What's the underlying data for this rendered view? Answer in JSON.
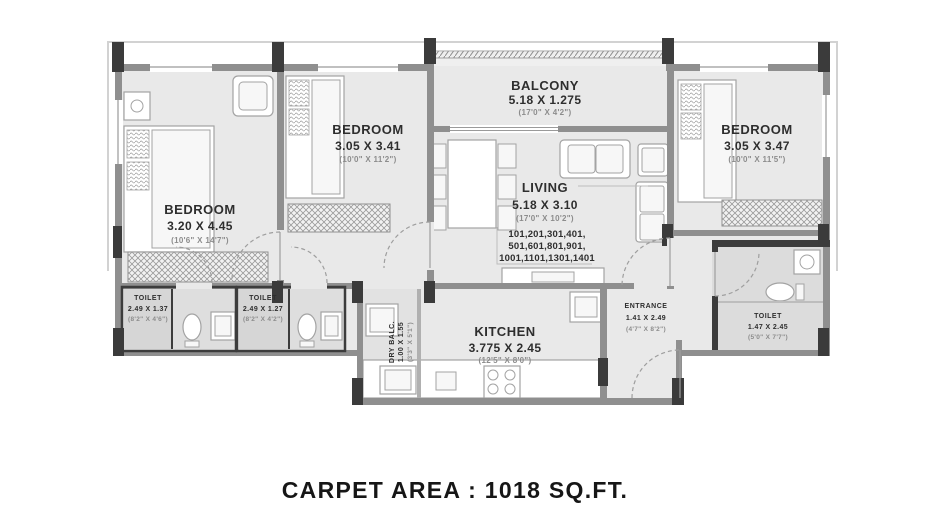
{
  "plan": {
    "caption": "CARPET AREA : 1018 SQ.FT.",
    "rooms": {
      "bedroom_left": {
        "name": "BEDROOM",
        "size_m": "3.20 X 4.45",
        "size_ft": "(10'6\" X 14'7\")"
      },
      "bedroom_mid": {
        "name": "BEDROOM",
        "size_m": "3.05 X 3.41",
        "size_ft": "(10'0\" X 11'2\")"
      },
      "bedroom_right": {
        "name": "BEDROOM",
        "size_m": "3.05 X 3.47",
        "size_ft": "(10'0\" X 11'5\")"
      },
      "balcony": {
        "name": "BALCONY",
        "size_m": "5.18 X 1.275",
        "size_ft": "(17'0\" X 4'2\")"
      },
      "living": {
        "name": "LIVING",
        "size_m": "5.18 X 3.10",
        "size_ft": "(17'0\" X 10'2\")"
      },
      "kitchen": {
        "name": "KITCHEN",
        "size_m": "3.775 X 2.45",
        "size_ft": "(12'5\" X 8'0\")"
      },
      "dry_balcony": {
        "name": "DRY BALC.",
        "size_m": "1.00 X 1.55",
        "size_ft": "(3'3\" X 5'1\")"
      },
      "toilet_1": {
        "name": "TOILET",
        "size_m": "2.49 X 1.37",
        "size_ft": "(8'2\" X 4'6\")"
      },
      "toilet_2": {
        "name": "TOILET",
        "size_m": "2.49 X 1.27",
        "size_ft": "(8'2\" X 4'2\")"
      },
      "toilet_right": {
        "name": "TOILET",
        "size_m": "1.47 X 2.45",
        "size_ft": "(5'0\" X 7'7\")"
      },
      "entrance": {
        "name": "ENTRANCE",
        "size_m": "1.41 X 2.49",
        "size_ft": "(4'7\" X 8'2\")"
      }
    },
    "living_unit_numbers": [
      "101,201,301,401,",
      "501,601,801,901,",
      "1001,1101,1301,1401"
    ]
  },
  "colors": {
    "wall": "#8f8f8f",
    "column": "#3b3b3b",
    "floor": "#e9e9e9",
    "wet_area": "#d6d6d6",
    "text": "#2e2e2e",
    "text_muted": "#8c8c8c"
  }
}
